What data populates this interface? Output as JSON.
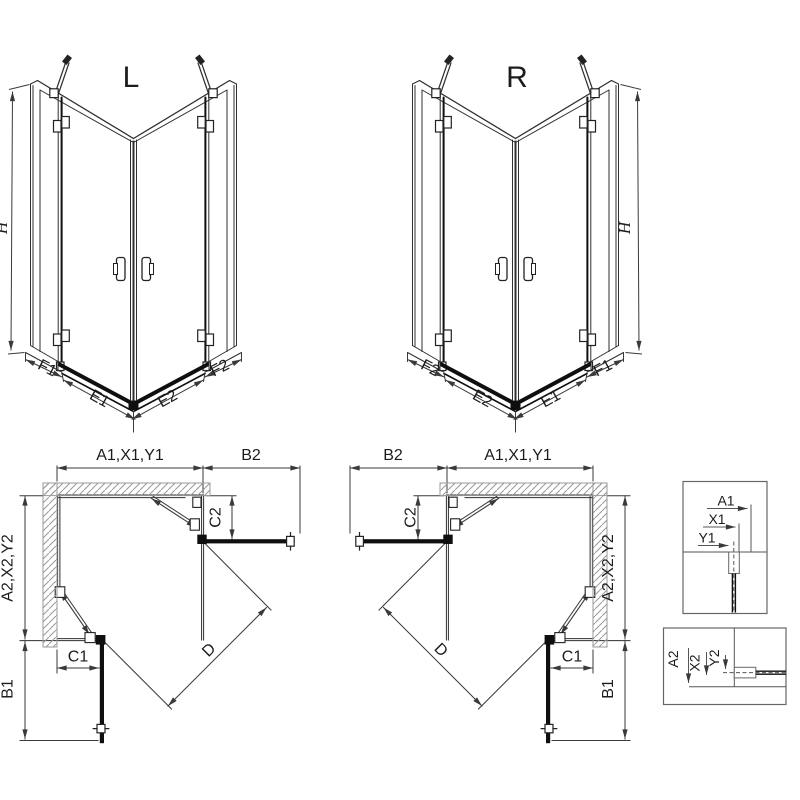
{
  "labels": {
    "view_l": {
      "title": "L",
      "height": "H",
      "side_left": "F1",
      "bottom_left": "E1",
      "bottom_right": "E2",
      "side_right": "F2"
    },
    "view_r": {
      "title": "R",
      "height": "H",
      "side_left": "F2",
      "bottom_left": "E2",
      "bottom_right": "E1",
      "side_right": "F1"
    },
    "plan_l": {
      "width_top": "A1,X1,Y1",
      "return_top": "B2",
      "return_depth_top": "C2",
      "depth_side": "A2,X2,Y2",
      "return_side": "B1",
      "return_width_bottom": "C1",
      "diagonal": "D"
    },
    "plan_r": {
      "width_top": "A1,X1,Y1",
      "return_top": "B2",
      "return_depth_top": "C2",
      "depth_side": "A2,X2,Y2",
      "return_side": "B1",
      "return_width_bottom": "C1",
      "diagonal": "D"
    },
    "detail_top": {
      "a1": "A1",
      "x1": "X1",
      "y1": "Y1"
    },
    "detail_bottom": {
      "a2": "A2",
      "x2": "X2",
      "y2": "Y2"
    }
  },
  "colors": {
    "line": "#2f2f2f",
    "dimension": "#3a3a3a",
    "panel_dark": "#0f0f0f",
    "hatch": "#999999",
    "detail_border": "#666666",
    "background": "#ffffff"
  }
}
